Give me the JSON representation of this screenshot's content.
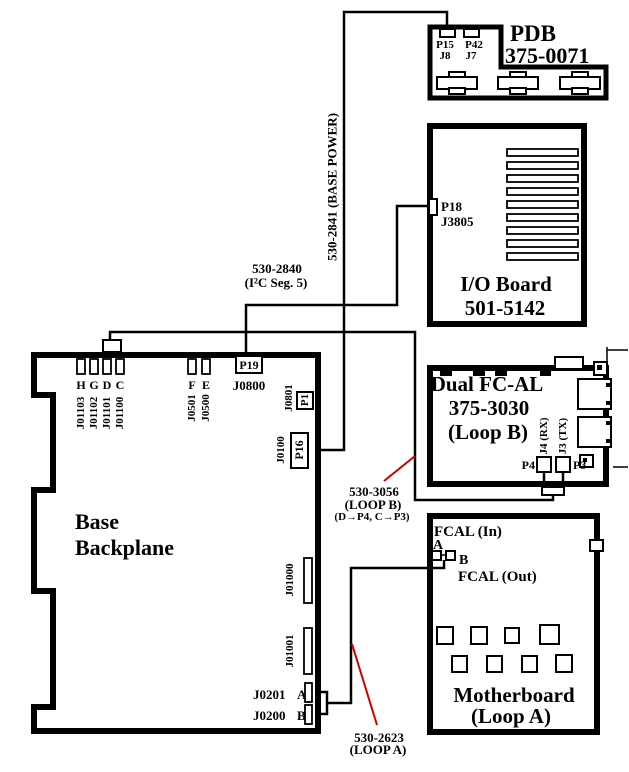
{
  "colors": {
    "ink": "#000000",
    "wire_red": "#cc0000",
    "background": "#ffffff"
  },
  "boards": {
    "pdb": {
      "name": "PDB",
      "part": "375-0071",
      "p15": "P15",
      "p42": "P42",
      "j8": "J8",
      "j7": "J7"
    },
    "io": {
      "name": "I/O Board",
      "part": "501-5142",
      "p18": "P18",
      "j3805": "J3805"
    },
    "fcal": {
      "name": "Dual FC-AL",
      "part": "375-3030",
      "loop": "(Loop B)",
      "p4": "P4",
      "p3": "P3",
      "j4_rx": "J4 (RX)",
      "j3_tx": "J3 (TX)"
    },
    "mb": {
      "name": "Motherboard",
      "loop": "(Loop A)",
      "fcal_in": "FCAL (In)",
      "fcal_out": "FCAL (Out)",
      "a": "A",
      "b": "B"
    },
    "backplane": {
      "name1": "Base",
      "name2": "Backplane",
      "top_slots": [
        {
          "j": "J01103",
          "k": "H"
        },
        {
          "j": "J01102",
          "k": "G"
        },
        {
          "j": "J01101",
          "k": "D"
        },
        {
          "j": "J01100",
          "k": "C"
        },
        {
          "j": "J0501",
          "k": "F"
        },
        {
          "j": "J0500",
          "k": "E"
        }
      ],
      "p19": "P19",
      "j0800": "J0800",
      "j0801": "J0801",
      "p1": "P1",
      "j0100": "J0100",
      "p16": "P16",
      "j01000": "J01000",
      "j01001": "J01001",
      "j0201": "J0201",
      "j0201_key": "A",
      "j0200": "J0200",
      "j0200_key": "B"
    }
  },
  "cables": {
    "base_power": {
      "label": "530-2841 (BASE POWER)"
    },
    "i2c": {
      "line1": "530-2840",
      "line2": "(I²C Seg. 5)"
    },
    "loop_b": {
      "line1": "530-3056",
      "line2": "(LOOP B)",
      "line3": "(D→P4, C→P3)"
    },
    "loop_a": {
      "line1": "530-2623",
      "line2": "(LOOP A)"
    }
  }
}
